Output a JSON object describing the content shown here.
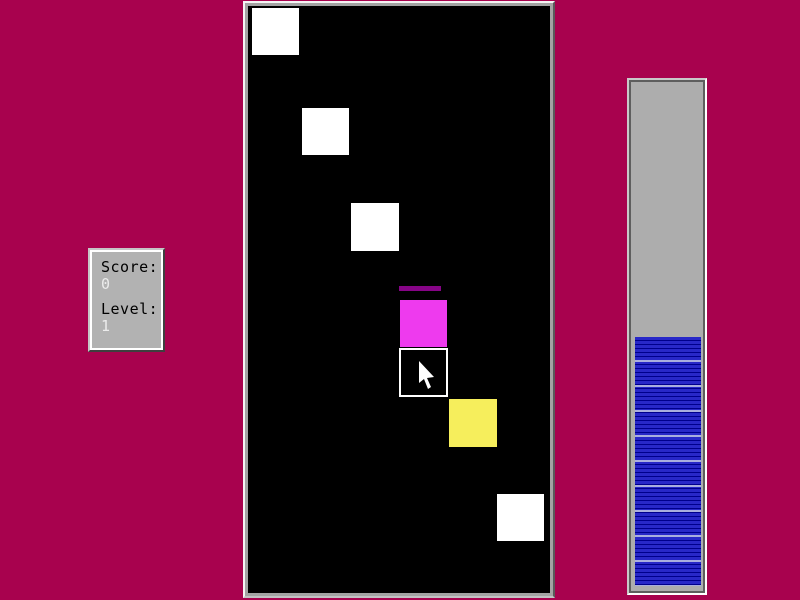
{
  "background_color": "#a8024e",
  "score_panel": {
    "score_label": "Score:",
    "score_value": "0",
    "level_label": "Level:",
    "level_value": "1"
  },
  "playfield": {
    "background_color": "#000000",
    "squares": [
      {
        "name": "tile-white-1",
        "type": "tile",
        "color": "#ffffff",
        "x": 7,
        "y": 5,
        "w": 47,
        "h": 47
      },
      {
        "name": "tile-white-2",
        "type": "tile",
        "color": "#ffffff",
        "x": 57,
        "y": 105,
        "w": 47,
        "h": 47
      },
      {
        "name": "tile-white-3",
        "type": "tile",
        "color": "#ffffff",
        "x": 106,
        "y": 200,
        "w": 48,
        "h": 48
      },
      {
        "name": "tile-trail-artifact",
        "type": "artifact",
        "color": "#860486",
        "x": 154,
        "y": 283,
        "w": 42,
        "h": 5
      },
      {
        "name": "tile-magenta",
        "type": "tile",
        "color": "#ee3aee",
        "x": 155,
        "y": 297,
        "w": 47,
        "h": 47
      },
      {
        "name": "tile-selected",
        "type": "outlined",
        "color": "#000000",
        "border_color": "#ffffff",
        "x": 154,
        "y": 345,
        "w": 49,
        "h": 49
      },
      {
        "name": "tile-yellow",
        "type": "tile",
        "color": "#f6ee5c",
        "x": 204,
        "y": 396,
        "w": 48,
        "h": 48
      },
      {
        "name": "tile-white-4",
        "type": "tile",
        "color": "#ffffff",
        "x": 252,
        "y": 491,
        "w": 47,
        "h": 47
      }
    ]
  },
  "cursor": {
    "x": 173,
    "y": 358,
    "color": "#ffffff"
  },
  "timer_bar": {
    "fill_percent": 49,
    "fill_color": "#2828c8",
    "separator_color": "#00008c",
    "highlight_stripe_color": "#a9aede",
    "track_color": "#adadad"
  }
}
